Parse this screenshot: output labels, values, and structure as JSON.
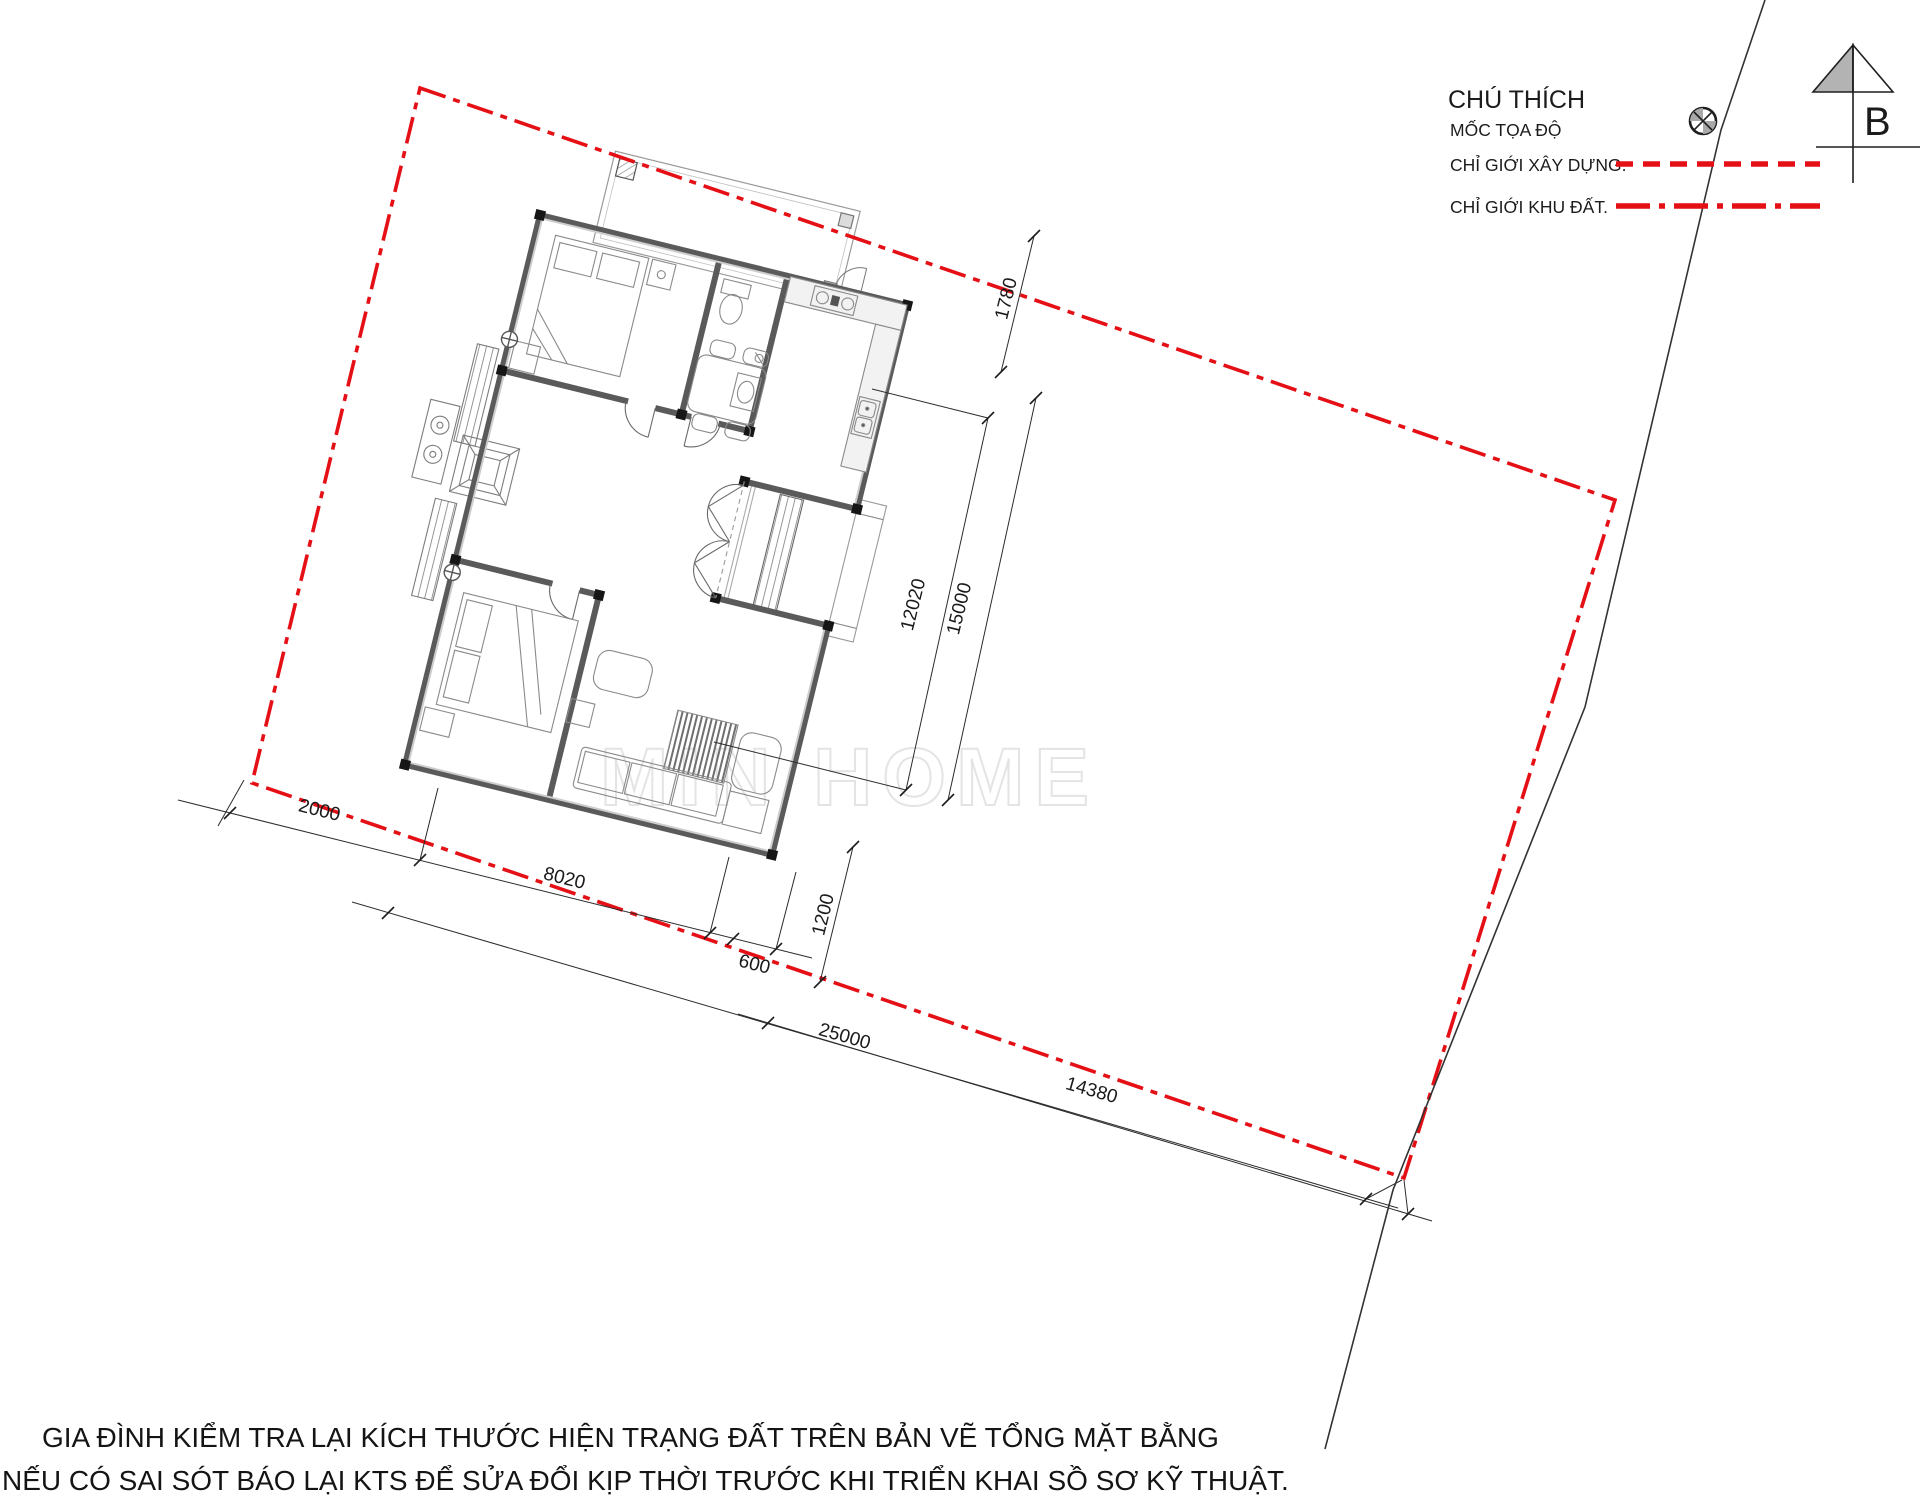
{
  "legend": {
    "title": "CHÚ THÍCH",
    "items": [
      {
        "label": "MỐC TỌA ĐỘ",
        "symbol": "survey-marker-icon"
      },
      {
        "label": "CHỈ GIỚI XÂY DỰNG.",
        "line_style": "dashed",
        "color": "#e50f16"
      },
      {
        "label": "CHỈ GIỚI KHU ĐẤT.",
        "line_style": "dash-dot",
        "color": "#e50f16"
      }
    ]
  },
  "north_arrow": {
    "label": "B"
  },
  "dimensions": {
    "d1780": "1780",
    "d12020": "12020",
    "d15000": "15000",
    "d2000": "2000",
    "d8020": "8020",
    "d600": "600",
    "d1200": "1200",
    "d25000": "25000",
    "d14380": "14380"
  },
  "watermark": "MIN HOME",
  "notes": {
    "line1": "GIA ĐÌNH KIỂM TRA LẠI KÍCH THƯỚC HIỆN TRẠNG  ĐẤT TRÊN BẢN VẼ TỔNG MẶT BẰNG",
    "line2": "NẾU CÓ SAI SÓT BÁO LẠI KTS  ĐỂ SỬA ĐỔI KỊP THỜI TRƯỚC KHI TRIỂN KHAI SỒ SƠ KỸ THUẬT."
  },
  "colors": {
    "boundary_red": "#e50f16",
    "wall": "#4a4a4a",
    "road_line": "#333333",
    "watermark_gray": "#e4e4e4"
  }
}
